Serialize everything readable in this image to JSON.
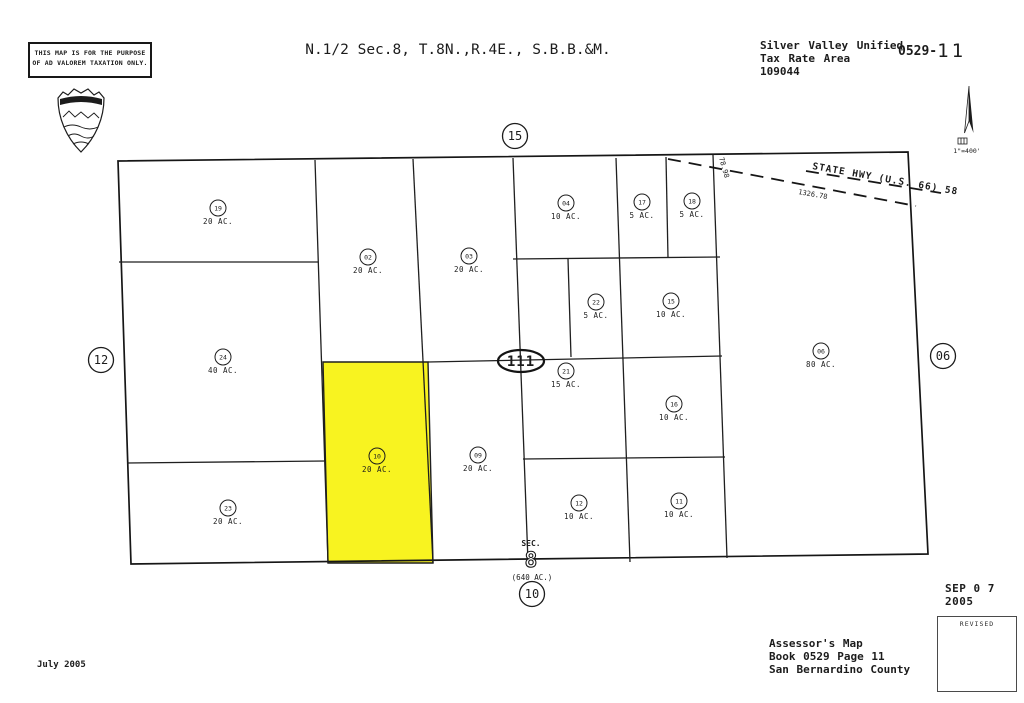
{
  "page": {
    "background": "#ffffff",
    "ink": "#1c1c1c"
  },
  "header": {
    "title": "N.1/2 Sec.8, T.8N.,R.4E., S.B.B.&M.",
    "district": "Silver Valley Unified",
    "tax_rate_area_label": "Tax Rate Area",
    "tax_rate_area_code": "109044",
    "book_page_prefix": "0529-",
    "page_number_handwritten": "11",
    "disclaimer_line1": "THIS MAP IS FOR THE PURPOSE",
    "disclaimer_line2": "OF AD VALOREM TAXATION ONLY."
  },
  "north_scale": {
    "scale_label": "1\"=400'"
  },
  "map": {
    "highlight_color": "#F8F320",
    "highway_label": "STATE HWY (U.S. 66) 58",
    "highway_dimension": "1326.78",
    "edge_dimension": "78.98",
    "section_marker": {
      "label": "SEC.",
      "number": "8",
      "acreage": "(640 AC.)"
    },
    "parcels": [
      {
        "apn": "19",
        "acres": "20 AC.",
        "x": 218,
        "y": 208
      },
      {
        "apn": "02",
        "acres": "20 AC.",
        "x": 368,
        "y": 257
      },
      {
        "apn": "03",
        "acres": "20 AC.",
        "x": 469,
        "y": 256
      },
      {
        "apn": "04",
        "acres": "10 AC.",
        "x": 566,
        "y": 203
      },
      {
        "apn": "17",
        "acres": "5 AC.",
        "x": 642,
        "y": 202
      },
      {
        "apn": "18",
        "acres": "5 AC.",
        "x": 692,
        "y": 201
      },
      {
        "apn": "22",
        "acres": "5 AC.",
        "x": 596,
        "y": 302
      },
      {
        "apn": "15",
        "acres": "10 AC.",
        "x": 671,
        "y": 301
      },
      {
        "apn": "24",
        "acres": "40 AC.",
        "x": 223,
        "y": 357
      },
      {
        "apn": "21",
        "acres": "15 AC.",
        "x": 566,
        "y": 371
      },
      {
        "apn": "16",
        "acres": "10 AC.",
        "x": 674,
        "y": 404
      },
      {
        "apn": "06",
        "acres": "80 AC.",
        "x": 821,
        "y": 351
      },
      {
        "apn": "10",
        "acres": "20 AC.",
        "x": 377,
        "y": 456,
        "highlighted": true
      },
      {
        "apn": "09",
        "acres": "20 AC.",
        "x": 478,
        "y": 455
      },
      {
        "apn": "23",
        "acres": "20 AC.",
        "x": 228,
        "y": 508
      },
      {
        "apn": "12",
        "acres": "10 AC.",
        "x": 579,
        "y": 503
      },
      {
        "apn": "11",
        "acres": "10 AC.",
        "x": 679,
        "y": 501
      }
    ],
    "adjacent_sections": [
      {
        "label": "15",
        "x": 515,
        "y": 136,
        "shape": "circle"
      },
      {
        "label": "12",
        "x": 101,
        "y": 360,
        "shape": "circle"
      },
      {
        "label": "06",
        "x": 943,
        "y": 356,
        "shape": "circle"
      },
      {
        "label": "10",
        "x": 532,
        "y": 594,
        "shape": "circle"
      },
      {
        "label": "111",
        "x": 521,
        "y": 361,
        "shape": "ellipse"
      }
    ]
  },
  "footer": {
    "date_prepared": "July 2005",
    "stamp_date": "SEP 0 7 2005",
    "revised_label": "REVISED",
    "assessor_line1": "Assessor's Map",
    "assessor_line2": "Book 0529 Page 11",
    "assessor_line3": "San Bernardino County"
  }
}
